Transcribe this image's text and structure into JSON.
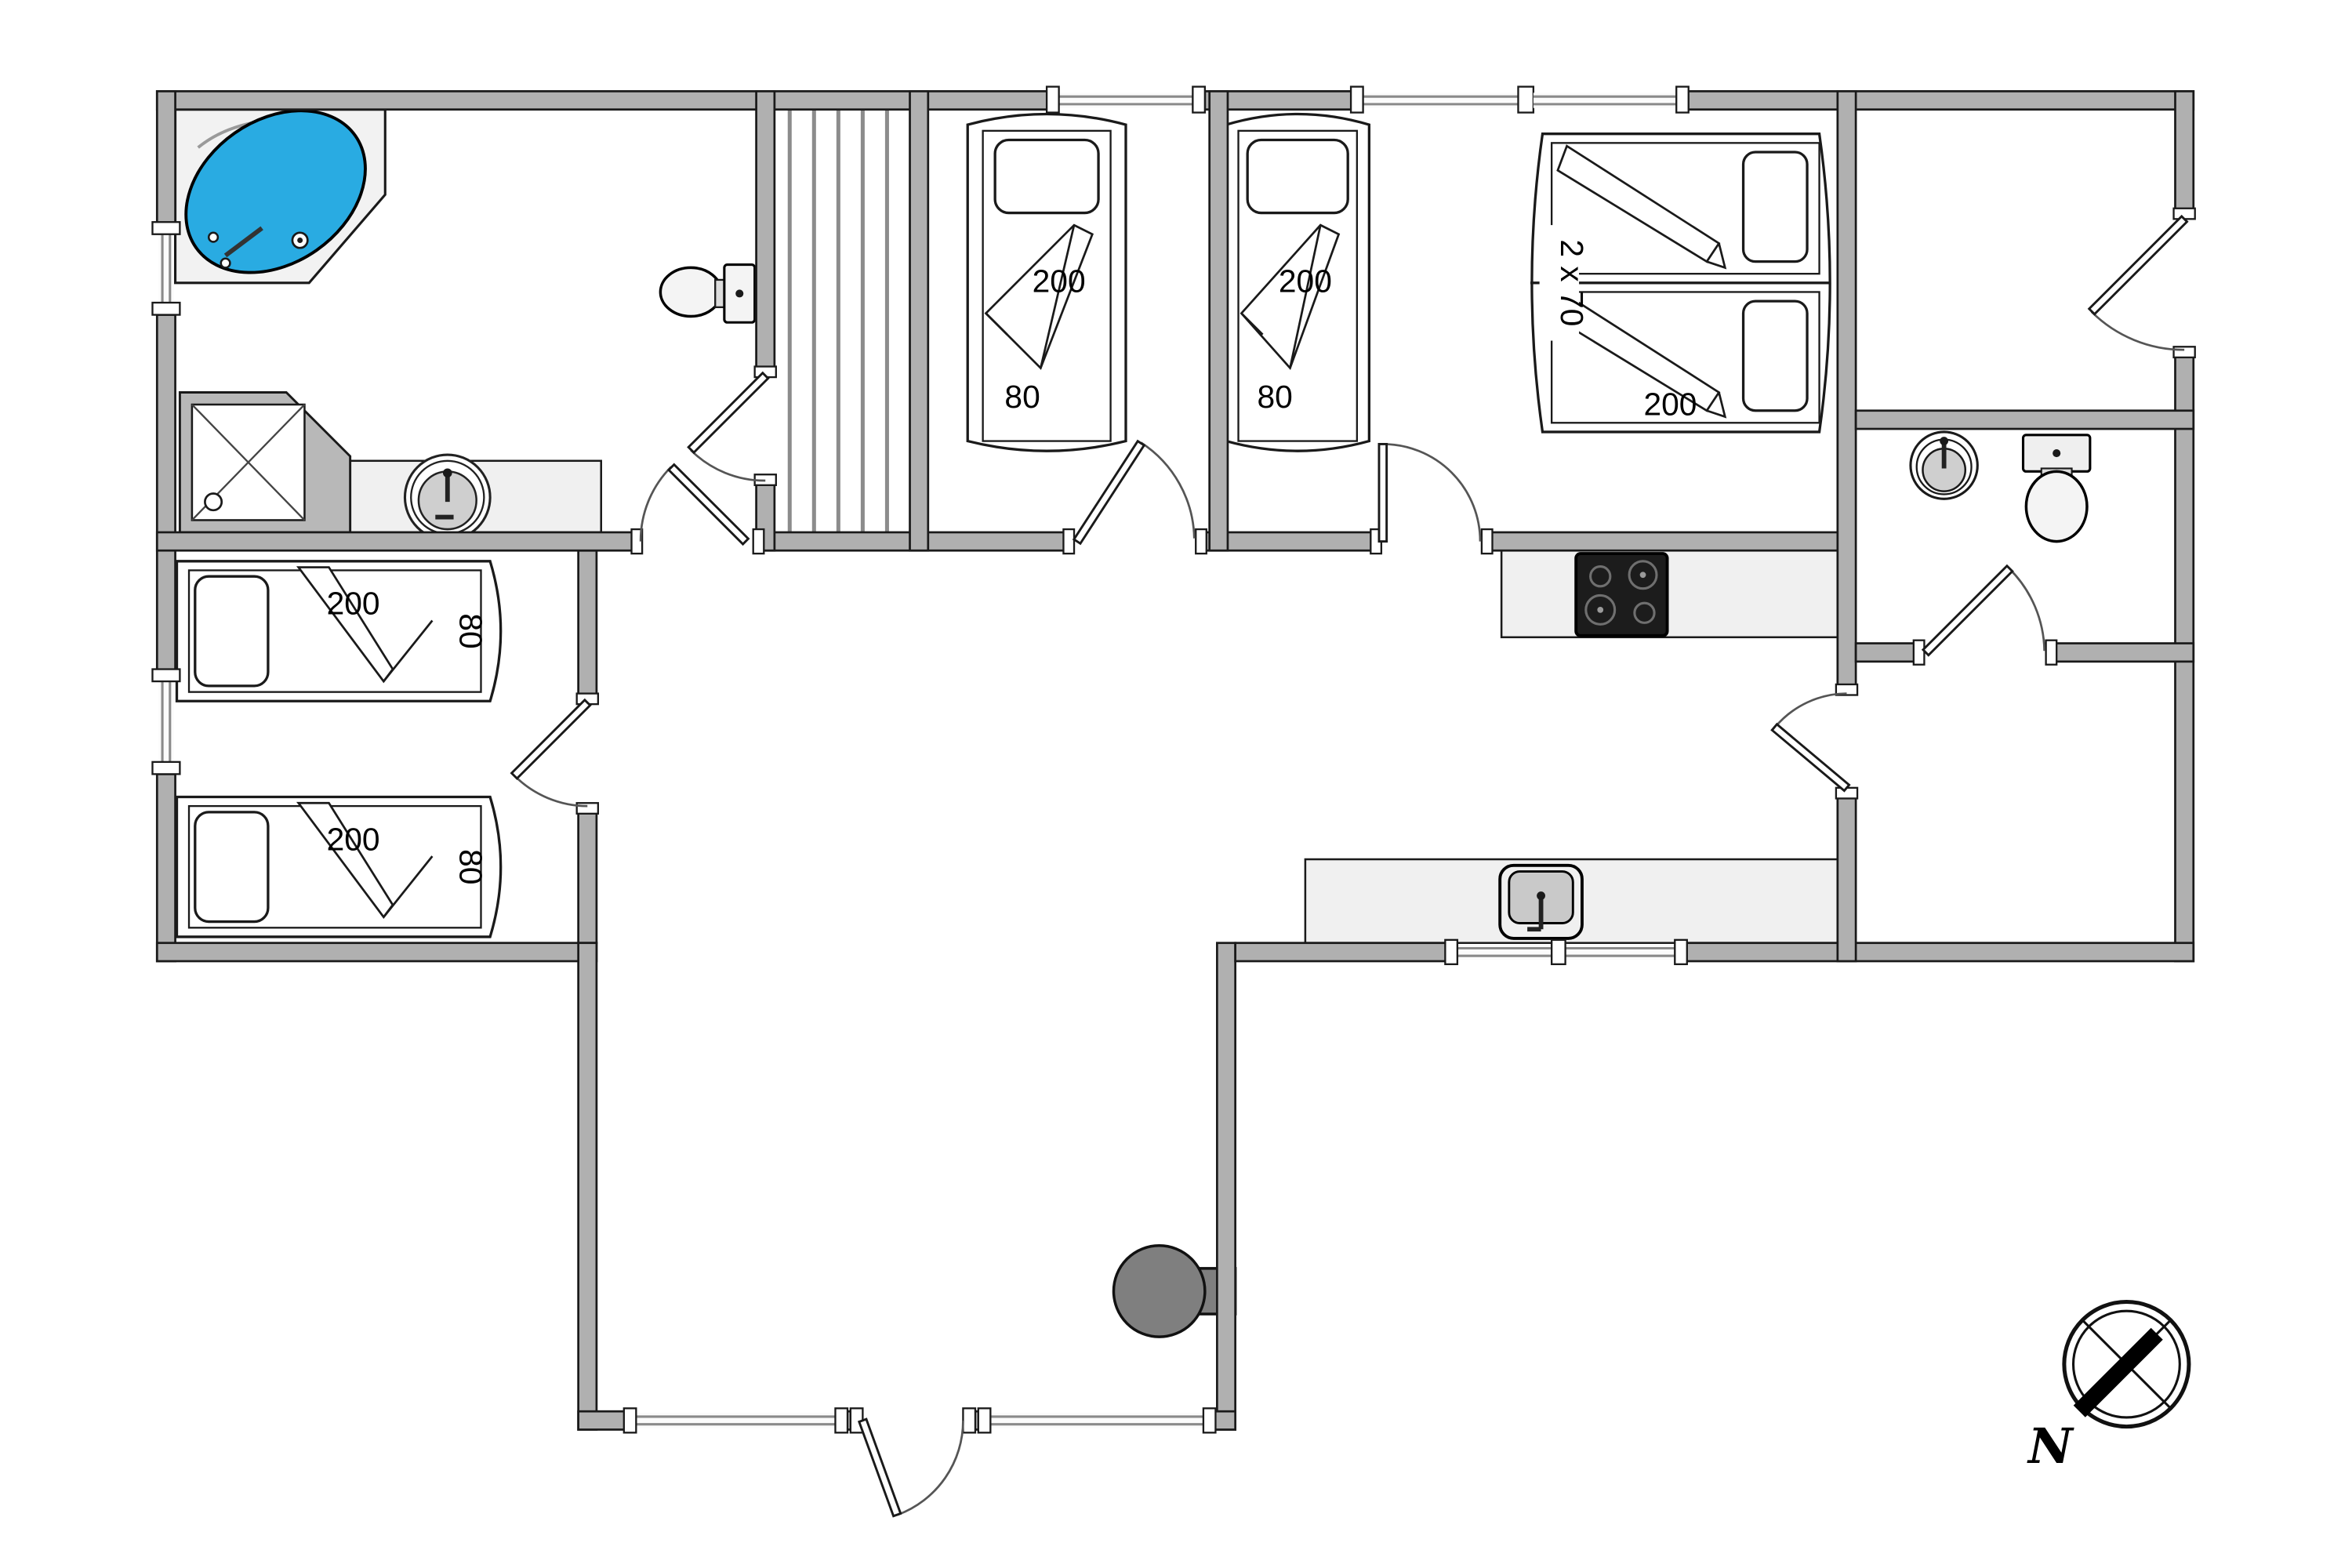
{
  "figure_type": "floor-plan",
  "colors": {
    "wall": "#b0b0b0",
    "tub": "#29abe2",
    "counter": "#f0f0f0",
    "cooktop": "#1c1c1c",
    "fireplace": "#7f7f7f",
    "outline": "#1a1a1a"
  },
  "labels": {
    "bedroom1_bed": {
      "length": "200",
      "width": "80"
    },
    "family_room_single_bed": {
      "length": "200",
      "width": "80"
    },
    "family_room_double_bed": {
      "width_each": "2 x 70",
      "length": "200"
    },
    "kids_room_bed_top": {
      "length": "200",
      "width": "80"
    },
    "kids_room_bed_bottom": {
      "length": "200",
      "width": "80"
    },
    "compass_north": "N"
  },
  "fixtures": [
    "corner-bathtub",
    "shower",
    "washbasin-round",
    "toilet",
    "sauna-bench-stripes",
    "toilet-small-bath",
    "washbasin-small-bath",
    "cooktop-4-burners",
    "kitchen-sink",
    "wood-stove",
    "compass-rose"
  ]
}
